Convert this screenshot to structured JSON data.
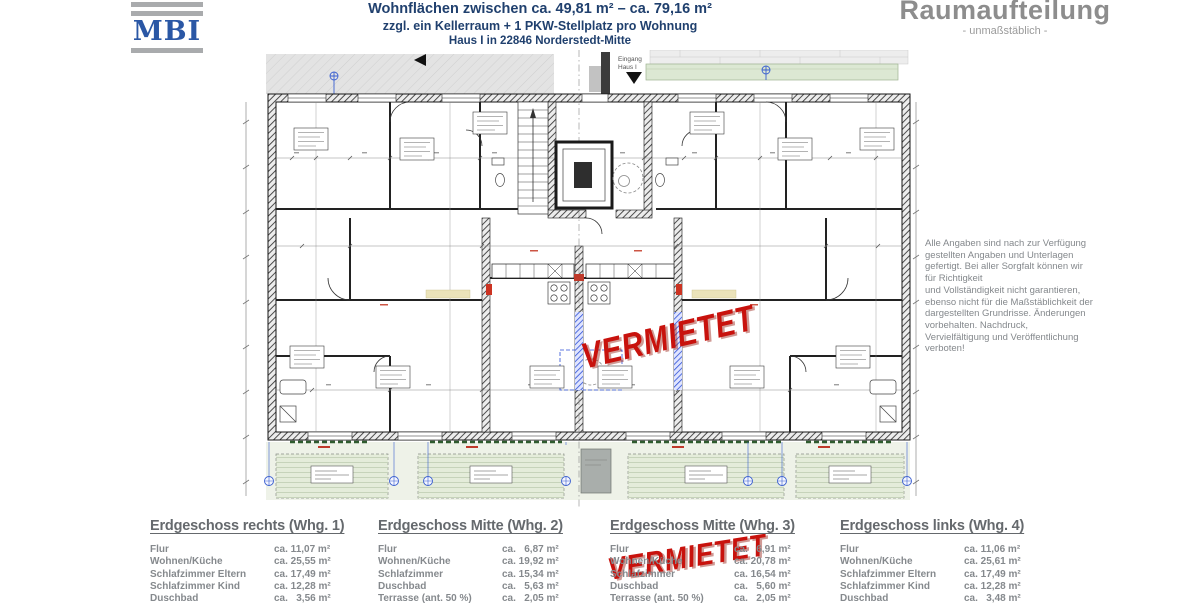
{
  "logo": {
    "text": "MBI"
  },
  "header": {
    "line1": "Wohnflächen zwischen ca. 49,81 m² – ca. 79,16 m²",
    "line2": "zzgl. ein Kellerraum + 1 PKW-Stellplatz pro Wohnung",
    "line3": "Haus I in 22846 Norderstedt-Mitte"
  },
  "title_block": {
    "title": "Raumaufteilung",
    "subtitle": "- unmaßstäblich -"
  },
  "plan": {
    "entrance_line1": "Eingang",
    "entrance_line2": "Haus I"
  },
  "stamps": {
    "plan": "VERMIETET",
    "list": "VERMIETET"
  },
  "disclaimer": "Alle Angaben sind nach zur Verfügung\ngestellten Angaben und Unterlagen\ngefertigt. Bei aller Sorgfalt können wir\nfür Richtigkeit\nund Vollständigkeit nicht garantieren,\nebenso nicht für die Maßstäblichkeit der\ndargestellten Grundrisse. Änderungen\nvorbehalten. Nachdruck,\nVervielfältigung und Veröffentlichung\nverboten!",
  "apartments": [
    {
      "title": "Erdgeschoss rechts (Whg. 1)",
      "rows": [
        {
          "label": "Flur",
          "value": "ca. 11,07 m²"
        },
        {
          "label": "Wohnen/Küche",
          "value": "ca. 25,55 m²"
        },
        {
          "label": "Schlafzimmer Eltern",
          "value": "ca. 17,49 m²"
        },
        {
          "label": "Schlafzimmer Kind",
          "value": "ca. 12,28 m²"
        },
        {
          "label": "Duschbad",
          "value": "ca.   3,56 m²"
        }
      ]
    },
    {
      "title": "Erdgeschoss Mitte (Whg. 2)",
      "rows": [
        {
          "label": "Flur",
          "value": "ca.   6,87 m²"
        },
        {
          "label": "Wohnen/Küche",
          "value": "ca. 19,92 m²"
        },
        {
          "label": "Schlafzimmer",
          "value": "ca. 15,34 m²"
        },
        {
          "label": "Duschbad",
          "value": "ca.   5,63 m²"
        },
        {
          "label": "Terrasse (ant. 50 %)",
          "value": "ca.   2,05 m²"
        }
      ]
    },
    {
      "title": "Erdgeschoss Mitte (Whg. 3)",
      "rows": [
        {
          "label": "Flur",
          "value": "ca.   6,91 m²"
        },
        {
          "label": "Wohnen/Küche",
          "value": "ca. 20,78 m²"
        },
        {
          "label": "Schlafzimmer",
          "value": "ca. 16,54 m²"
        },
        {
          "label": "Duschbad",
          "value": "ca.   5,60 m²"
        },
        {
          "label": "Terrasse (ant. 50 %)",
          "value": "ca.   2,05 m²"
        }
      ]
    },
    {
      "title": "Erdgeschoss links (Whg. 4)",
      "rows": [
        {
          "label": "Flur",
          "value": "ca. 11,06 m²"
        },
        {
          "label": "Wohnen/Küche",
          "value": "ca. 25,61 m²"
        },
        {
          "label": "Schlafzimmer Eltern",
          "value": "ca. 17,49 m²"
        },
        {
          "label": "Schlafzimmer Kind",
          "value": "ca. 12,28 m²"
        },
        {
          "label": "Duschbad",
          "value": "ca.   3,48 m²"
        }
      ]
    }
  ]
}
